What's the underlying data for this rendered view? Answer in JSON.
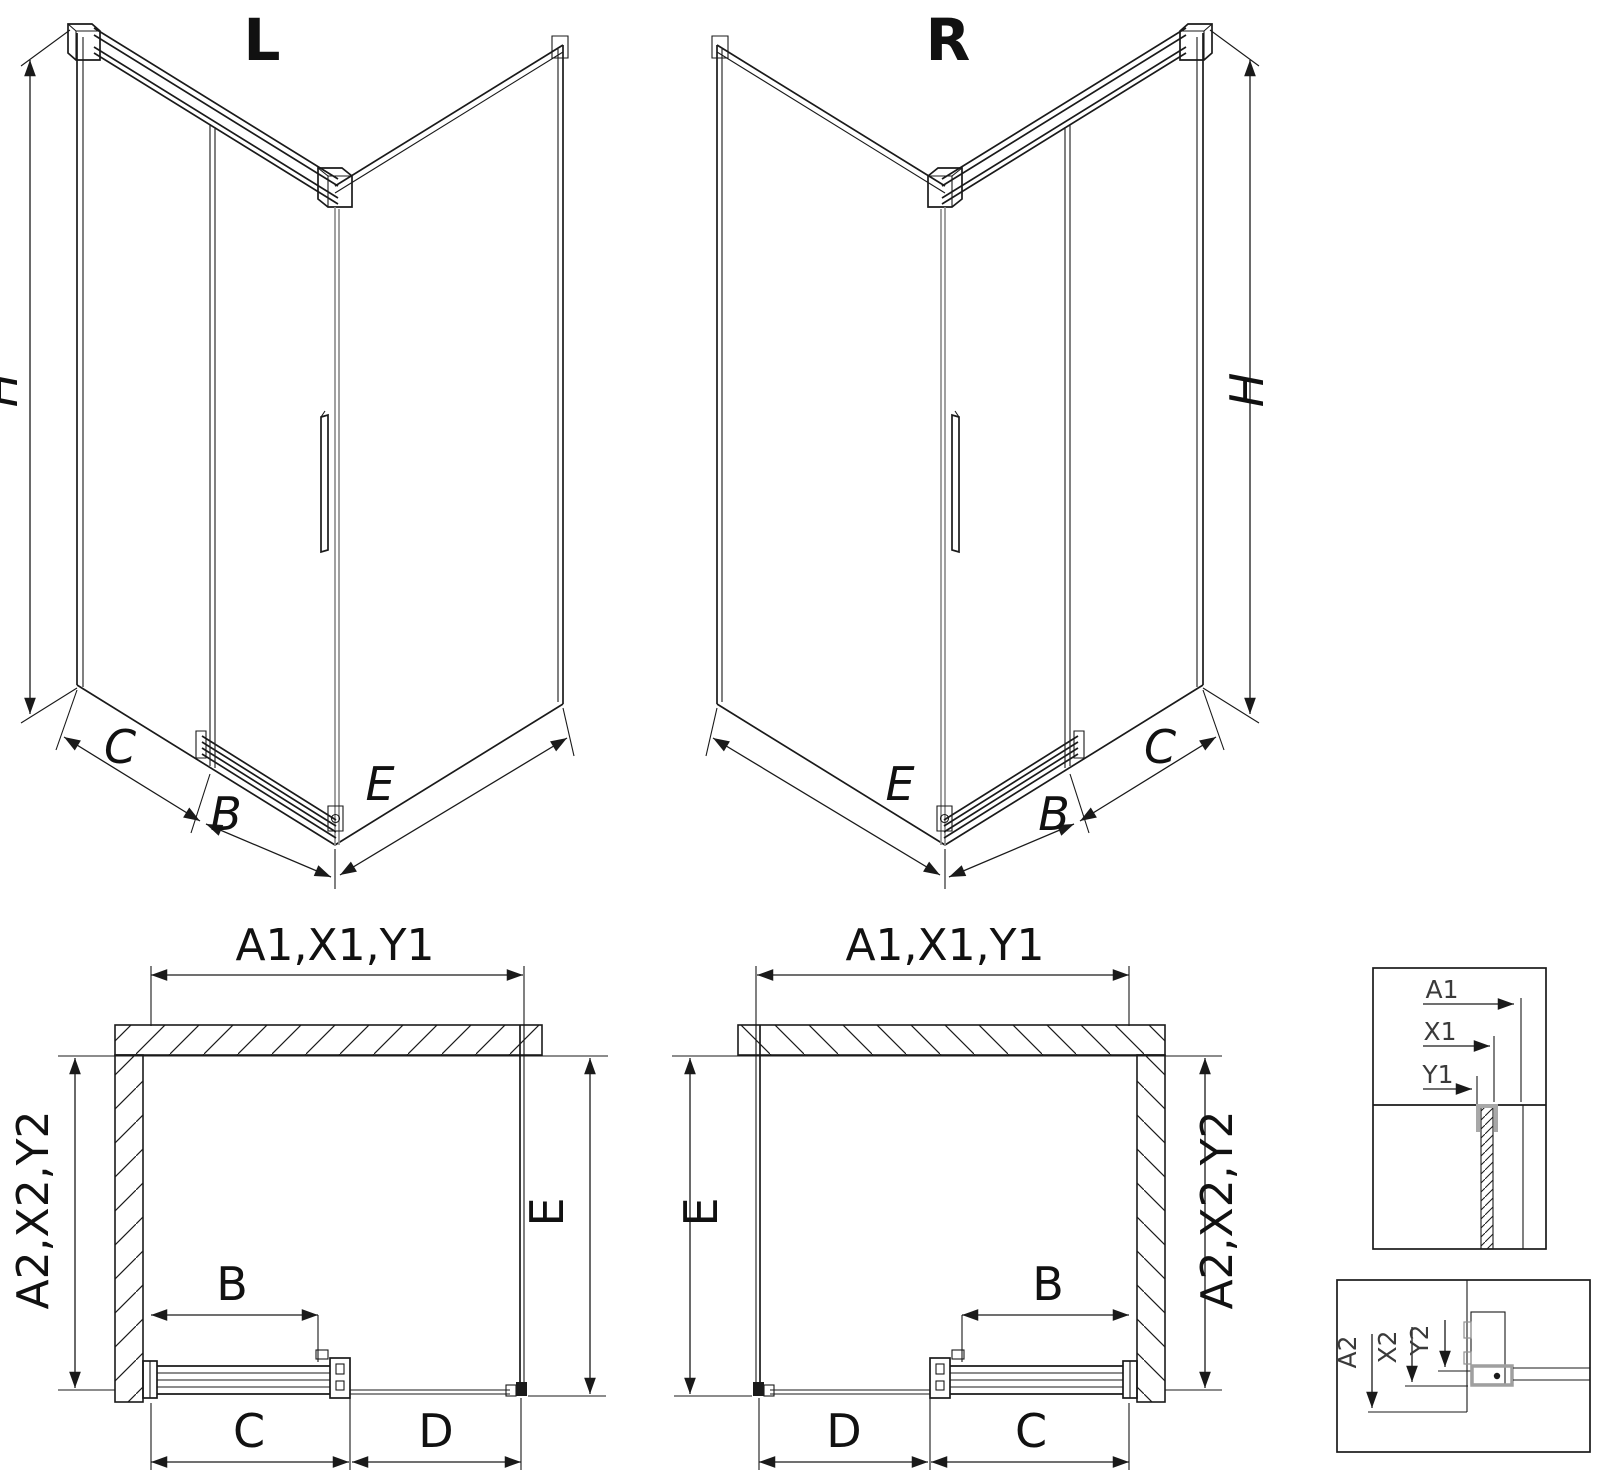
{
  "labels": {
    "left_variant": "L",
    "right_variant": "R",
    "height": "H",
    "door_width": "B",
    "fixed_panel": "C",
    "opening": "D",
    "return_panel": "E",
    "front_dims": "A1,X1,Y1",
    "side_dims": "A2,X2,Y2",
    "detail_front": [
      "A1",
      "X1",
      "Y1"
    ],
    "detail_side": [
      "A2",
      "X2",
      "Y2"
    ]
  },
  "colors": {
    "line": "#1a1a1a",
    "gray": "#909090",
    "text": "#111111",
    "bg": "#ffffff"
  }
}
